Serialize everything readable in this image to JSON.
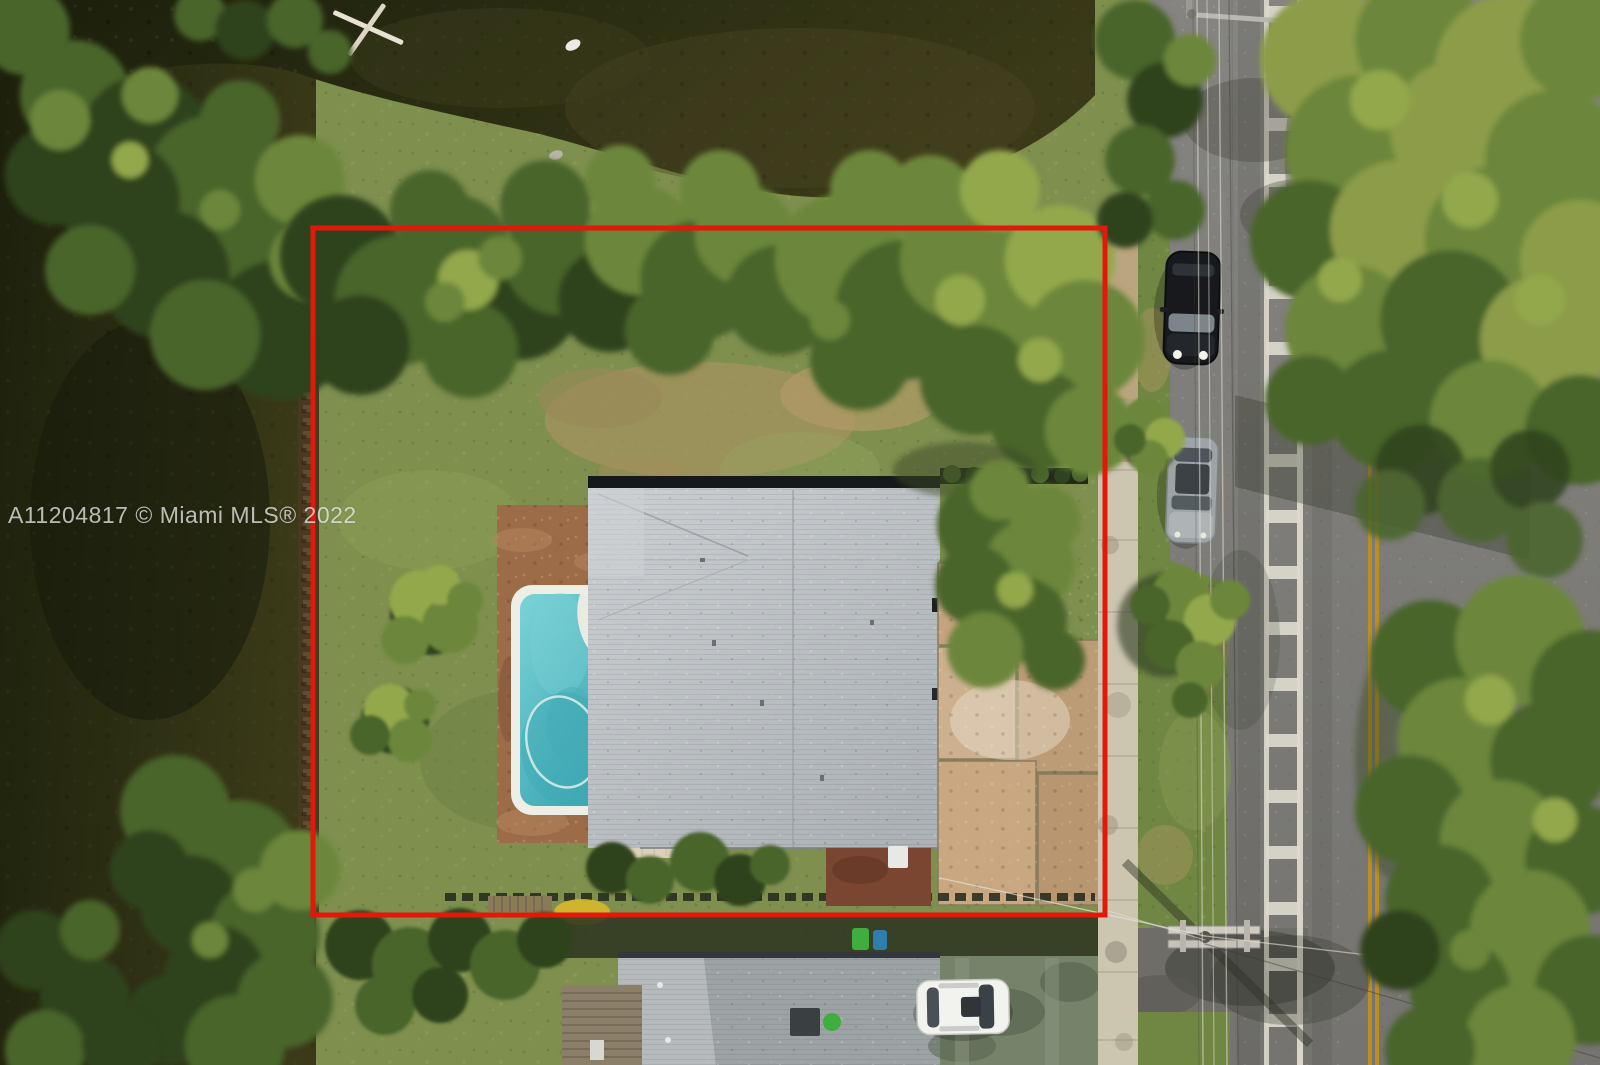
{
  "watermark": {
    "text": "A11204817 © Miami MLS® 2022"
  },
  "colors": {
    "boundary_red": "#E3170A",
    "water_dark": "#1C200C",
    "water_mid": "#3A3A18",
    "grass_base": "#7E8F4E",
    "canopy_dark": "#2E431E",
    "canopy_mid": "#4A652C",
    "canopy_light": "#6C873B",
    "canopy_bright": "#93A84C",
    "canopy_yellow": "#8C9C49",
    "roof_gray": "#C2C6C9",
    "roof_fascia": "#17181A",
    "neighbor_roof": "#9DA2A5",
    "pool_water": "#55BFC6",
    "pool_coping": "#EDEEE6",
    "deck_paver": "#9C6C49",
    "awning_beige": "#DCD2BA",
    "slab_tan": "#C4A37E",
    "sidewalk": "#CCC5B0",
    "road_gray": "#7B7A75",
    "apron_asphalt": "#6E6D68",
    "marking_white": "#DDD9CE",
    "line_yellow": "#BE8F1F",
    "mulch_brown": "#7A4632",
    "bin_green": "#3FAE3F",
    "bin_blue": "#2F7FAE",
    "car_black": "#17191C",
    "car_silver": "#9EA4A6",
    "car_white": "#F2F2EE",
    "watermark_color": "rgba(240,240,238,0.75)"
  }
}
